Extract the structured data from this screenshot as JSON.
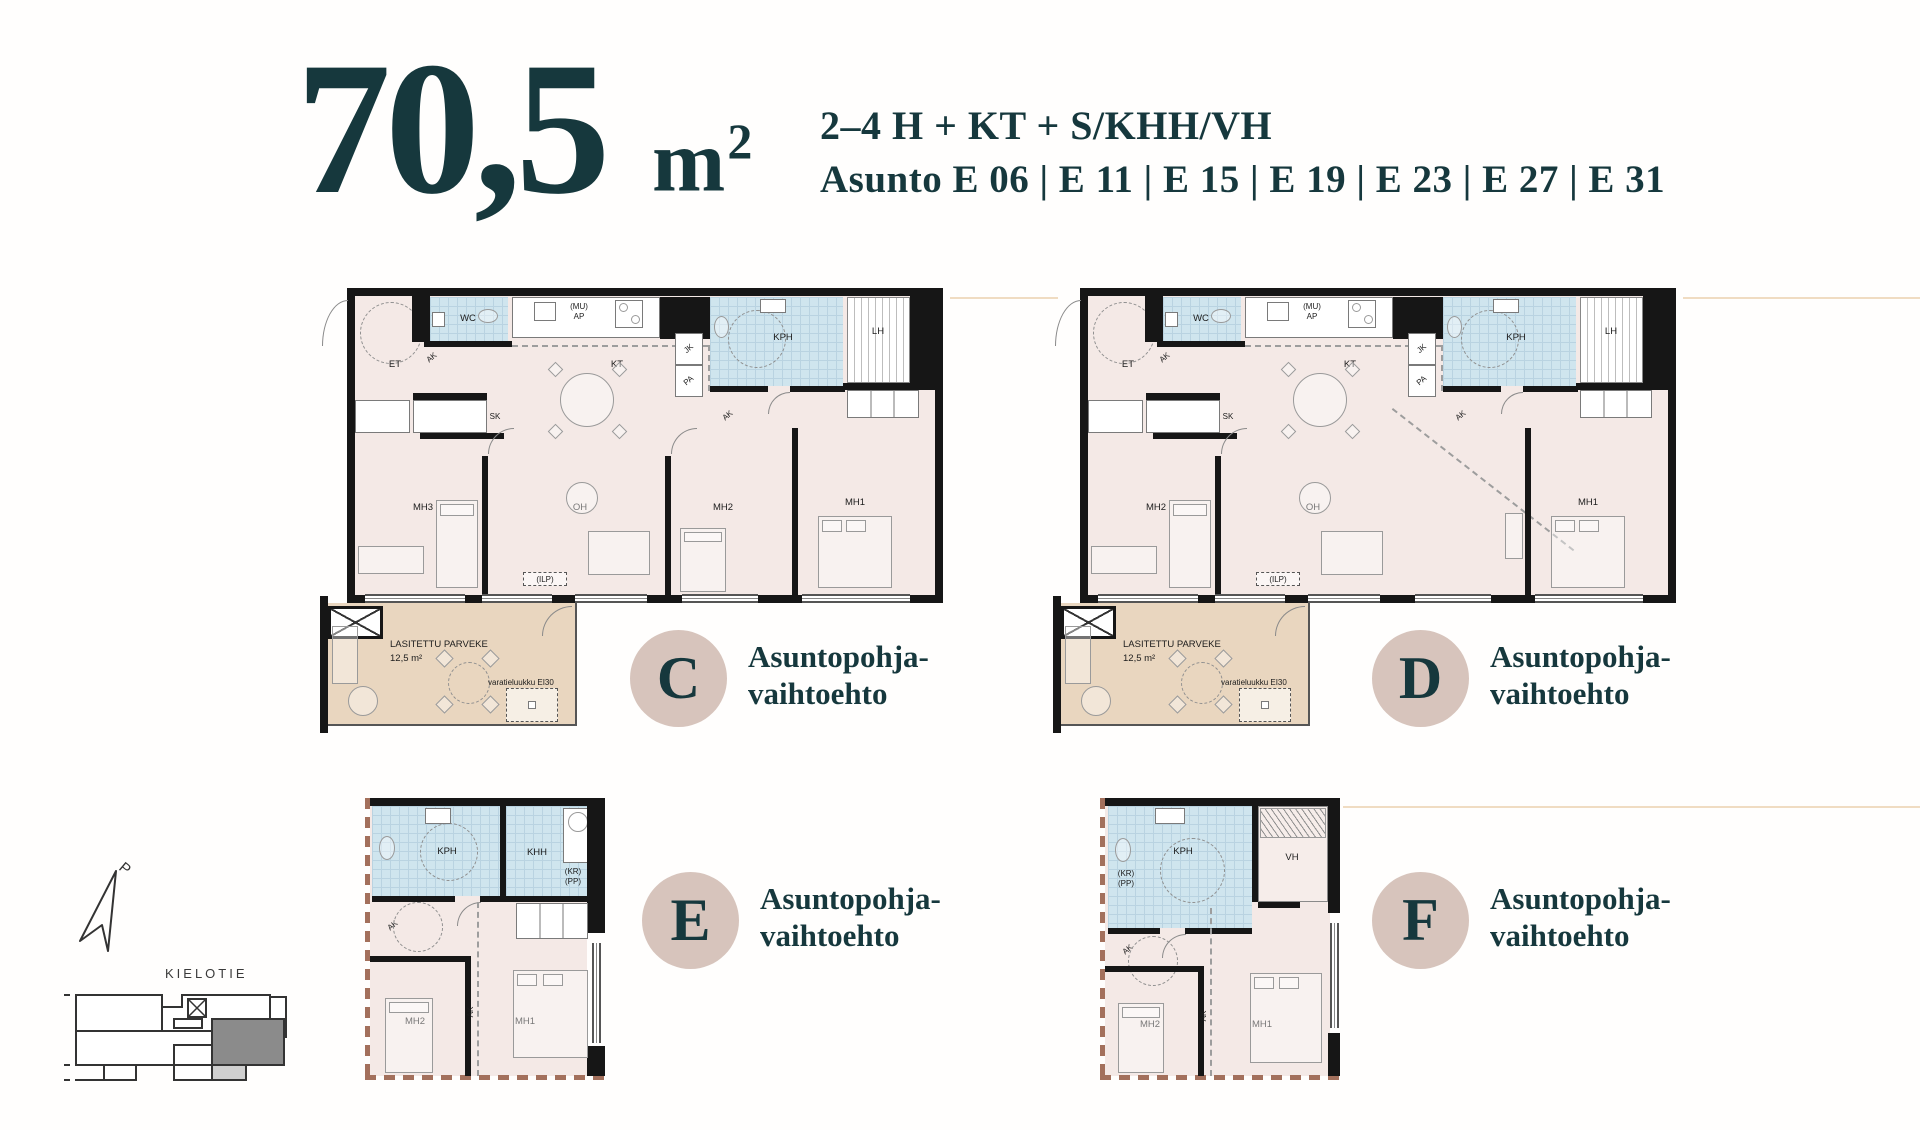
{
  "title": {
    "value": "70,5",
    "unit": "m",
    "unit_exp": "2"
  },
  "header": {
    "composition": "2–4 H + KT + S/KHH/VH",
    "asunto_label": "Asunto",
    "apartments": [
      "E 06",
      "E 11",
      "E 15",
      "E 19",
      "E 23",
      "E 27",
      "E 31"
    ]
  },
  "variant_label": {
    "line1": "Asuntopohja-",
    "line2": "vaihtoehto"
  },
  "variants": {
    "c": "C",
    "d": "D",
    "e": "E",
    "f": "F"
  },
  "rooms": {
    "c": {
      "et": "ET",
      "wc": "WC",
      "sk": "SK",
      "kt": "KT",
      "oh": "OH",
      "mh1": "MH1",
      "mh2": "MH2",
      "mh3": "MH3",
      "kph": "KPH",
      "lh": "LH",
      "jk": "JK",
      "pa": "PA",
      "ak": "AK",
      "kr": "(KR)",
      "pp": "(PP)",
      "mu": "(MU)",
      "ap": "AP",
      "ilp": "(ILP)"
    },
    "d": {
      "et": "ET",
      "wc": "WC",
      "sk": "SK",
      "kt": "KT",
      "oh": "OH",
      "mh1": "MH1",
      "mh2": "MH2",
      "kph": "KPH",
      "lh": "LH",
      "jk": "JK",
      "pa": "PA",
      "ak": "AK",
      "kr": "(KR)",
      "pp": "(PP)",
      "mu": "(MU)",
      "ap": "AP",
      "ilp": "(ILP)"
    },
    "e": {
      "kph": "KPH",
      "khh": "KHH",
      "mh1": "MH1",
      "mh2": "MH2",
      "ak": "AK",
      "kr": "(KR)",
      "pp": "(PP)"
    },
    "f": {
      "kph": "KPH",
      "vh": "VH",
      "mh1": "MH1",
      "mh2": "MH2",
      "ak": "AK",
      "kr": "(KR)",
      "pp": "(PP)"
    }
  },
  "balcony": {
    "title": "LASITETTU PARVEKE",
    "area": "12,5 m²",
    "hatch_label": "varatieluukku EI30"
  },
  "siteplan": {
    "street": "KIELOTIE",
    "north": "P"
  },
  "colors": {
    "teal": "#16383d",
    "badge": "#d7c4bc",
    "room_pink": "#f4e9e6",
    "room_blue": "#cfe5ee",
    "balcony_tan": "#e9d6bf",
    "dash_brown": "#a3705c",
    "wall": "#161616",
    "site_highlight": "#8b8b8b"
  }
}
